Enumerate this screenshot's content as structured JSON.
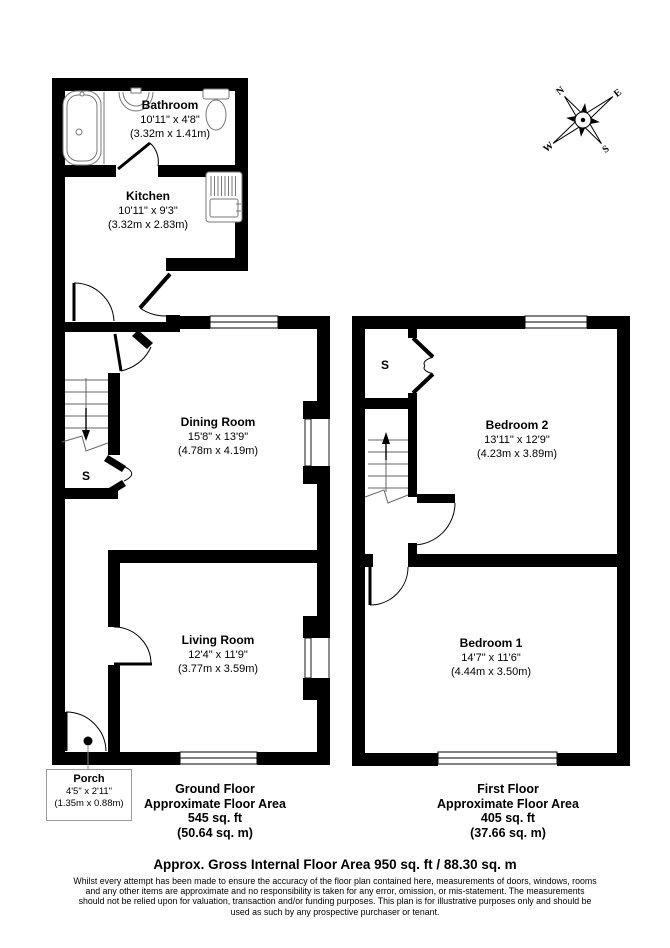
{
  "floorplan": {
    "rooms": {
      "bathroom": {
        "name": "Bathroom",
        "imperial": "10'11\" x 4'8\"",
        "metric": "(3.32m x 1.41m)"
      },
      "kitchen": {
        "name": "Kitchen",
        "imperial": "10'11\" x 9'3\"",
        "metric": "(3.32m x 2.83m)"
      },
      "dining_room": {
        "name": "Dining Room",
        "imperial": "15'8\" x 13'9\"",
        "metric": "(4.78m x 4.19m)"
      },
      "living_room": {
        "name": "Living Room",
        "imperial": "12'4\" x 11'9\"",
        "metric": "(3.77m x 3.59m)"
      },
      "porch": {
        "name": "Porch",
        "imperial": "4'5\" x 2'11\"",
        "metric": "(1.35m x 0.88m)"
      },
      "bedroom_2": {
        "name": "Bedroom 2",
        "imperial": "13'11\" x 12'9\"",
        "metric": "(4.23m x 3.89m)"
      },
      "bedroom_1": {
        "name": "Bedroom 1",
        "imperial": "14'7\" x 11'6\"",
        "metric": "(4.44m x 3.50m)"
      }
    },
    "storage_label": "S",
    "floors": {
      "ground": {
        "title": "Ground Floor",
        "subtitle": "Approximate Floor Area",
        "area_ft": "545 sq. ft",
        "area_m": "(50.64 sq. m)"
      },
      "first": {
        "title": "First Floor",
        "subtitle": "Approximate Floor Area",
        "area_ft": "405 sq. ft",
        "area_m": "(37.66 sq. m)"
      }
    },
    "compass": {
      "n": "N",
      "e": "E",
      "s": "S",
      "w": "W"
    },
    "footer": {
      "total": "Approx. Gross Internal Floor Area 950 sq. ft / 88.30 sq. m",
      "disclaimer": "Whilst every attempt has been made to ensure the accuracy of the floor plan contained here, measurements of doors, windows, rooms and any other items are approximate and no responsibility is taken for any error, omission, or mis-statement. The measurements should not be relied upon for valuation, transaction and/or funding purposes. This plan is for illustrative purposes only and should be used as such by any prospective purchaser or tenant."
    },
    "colors": {
      "wall": "#000000",
      "background": "#ffffff",
      "thin_line": "#666666"
    }
  }
}
